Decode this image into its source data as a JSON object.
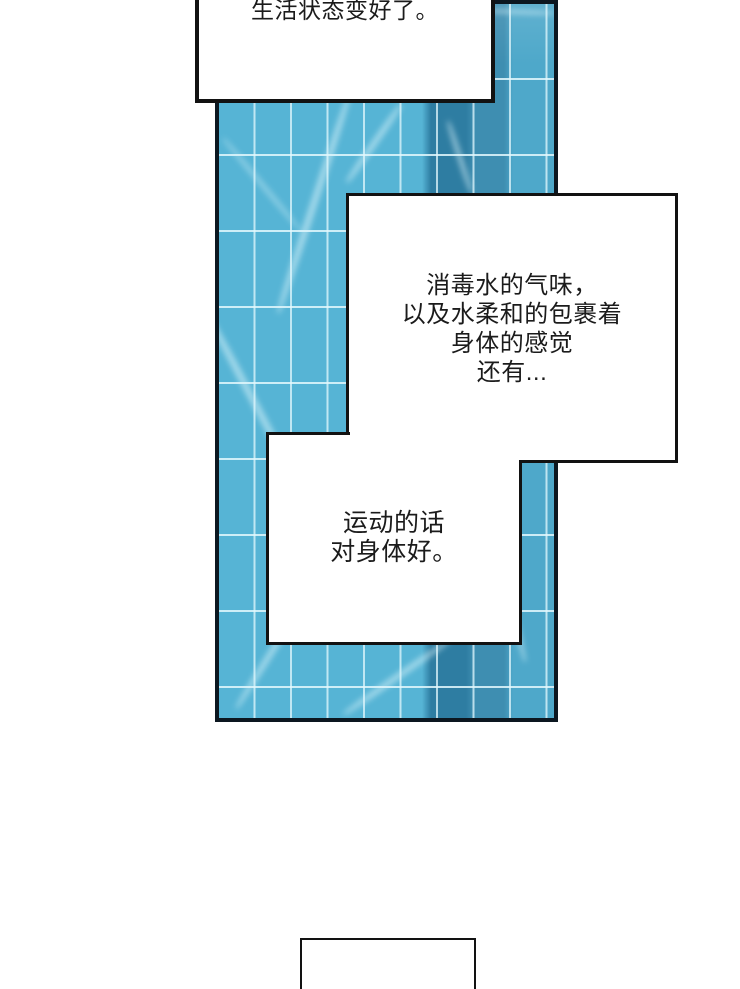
{
  "page_type": "webtoon-comic-page",
  "colors": {
    "pool-base": "#56b4d5",
    "lane-dark": "#2e7da2",
    "lane-mid": "#3e8eb1",
    "pool-right": "#4ea8ca",
    "grid-line": "#e3f8fd",
    "caustic": "#dcf4f9",
    "panel-border": "#0c1720",
    "box-border": "#121212",
    "ink": "#1b1b1b",
    "paper": "#ffffff"
  },
  "artwork": {
    "pool_panel": {
      "description": "vertical swimming-pool water panel with tile grid, dark lane stripe and light caustic reflections"
    }
  },
  "boxes": {
    "top": {
      "lines": [
        "生活状态变好了。"
      ]
    },
    "scent": {
      "lines": [
        "消毒水的气味，",
        "以及水柔和的包裹着",
        "身体的感觉",
        "还有..."
      ]
    },
    "exercise": {
      "lines": [
        "运动的话",
        "对身体好。"
      ]
    },
    "bottom": {
      "lines": []
    }
  }
}
